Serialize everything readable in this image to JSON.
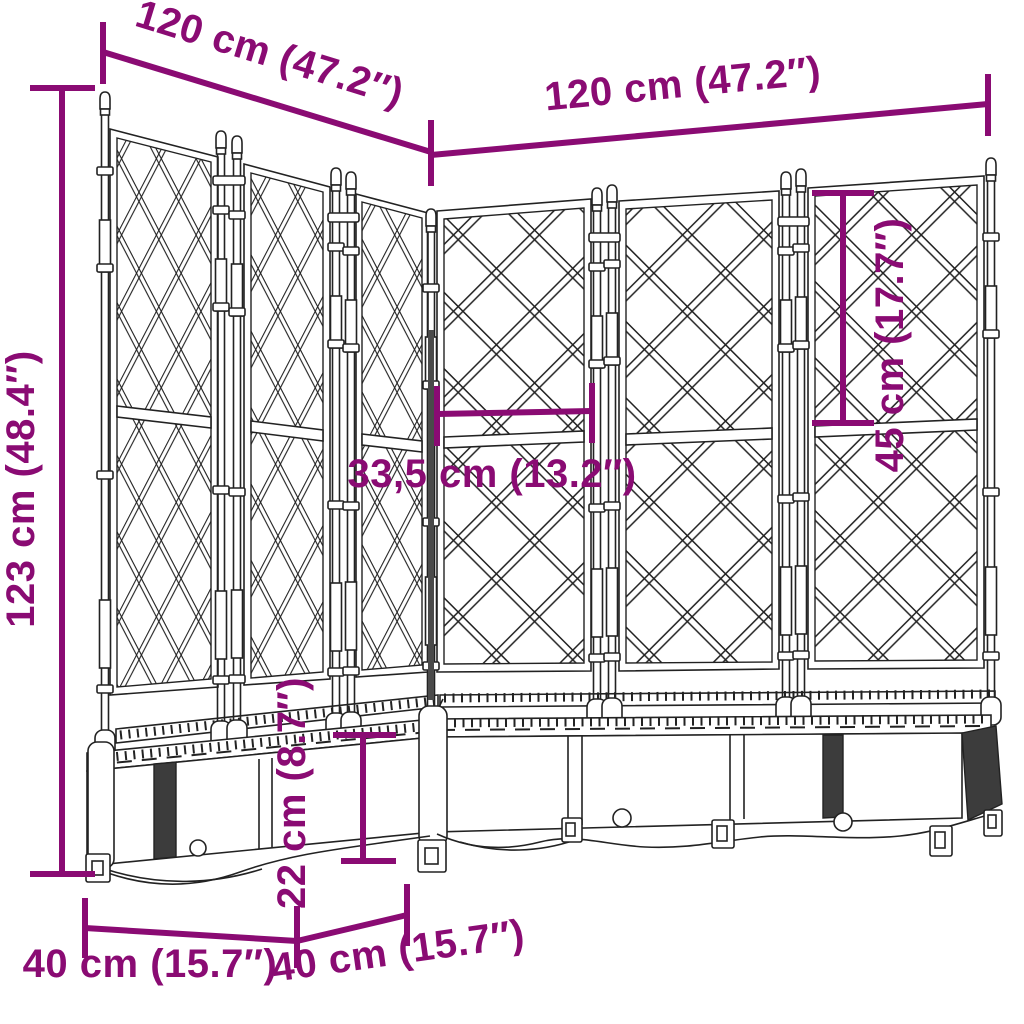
{
  "colors": {
    "dimension_purple": "#8A0B73",
    "line_art": "#222222",
    "background": "#FFFFFF"
  },
  "dimensions": {
    "left_run_length": "120 cm (47.2″)",
    "right_run_length": "120 cm (47.2″)",
    "total_height": "123 cm (48.4″)",
    "upper_trellis_height": "45 cm (17.7″)",
    "panel_width": "33,5 cm (13.2″)",
    "planter_box_height": "22 cm (8.7″)",
    "left_depth": "40 cm (15.7″)",
    "front_depth": "40 cm (15.7″)"
  }
}
